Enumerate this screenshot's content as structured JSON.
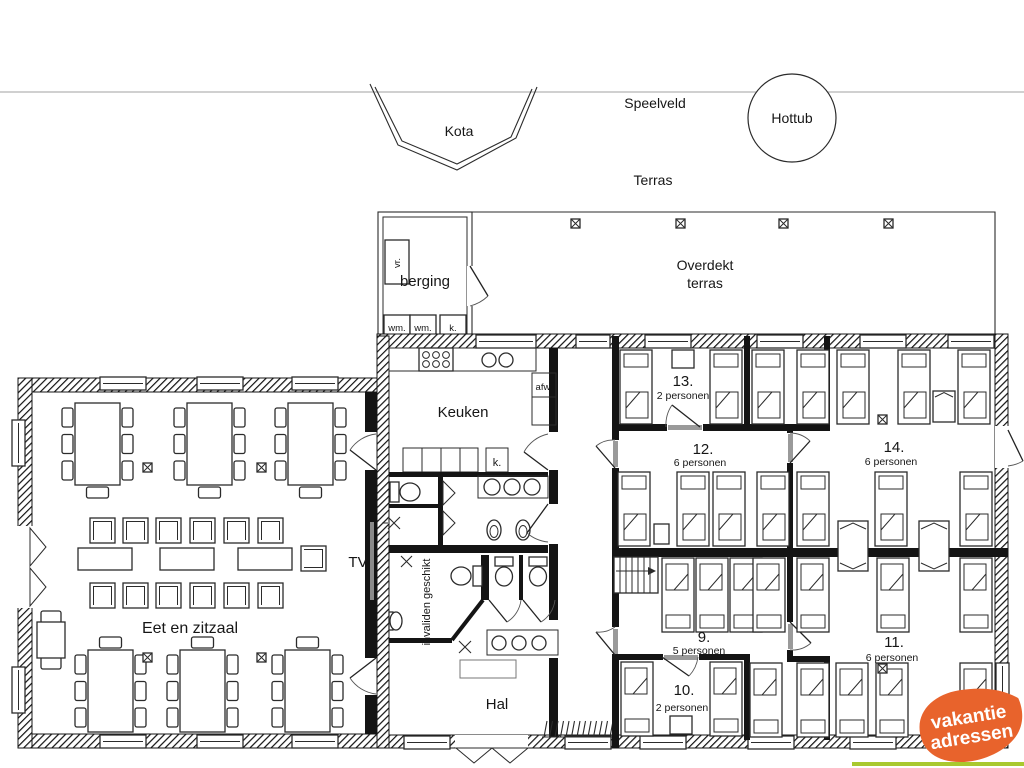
{
  "outdoor": {
    "kota": "Kota",
    "speelveld": "Speelveld",
    "hottub": "Hottub",
    "terras": "Terras",
    "overdekt1": "Overdekt",
    "overdekt2": "terras"
  },
  "berging": {
    "label": "berging",
    "vr": "vr.",
    "wm1": "wm.",
    "wm2": "wm.",
    "k": "k."
  },
  "kitchen": {
    "label": "Keuken",
    "afw": "afw.",
    "k": "k."
  },
  "dining": {
    "label": "Eet  en zitzaal",
    "tv": "TV"
  },
  "hal": {
    "label": "Hal",
    "invaliden": "invaliden geschikt"
  },
  "rooms": {
    "r13": {
      "number": "13.",
      "capacity": "2 personen"
    },
    "r12": {
      "number": "12.",
      "capacity": "6 personen"
    },
    "r14": {
      "number": "14.",
      "capacity": "6 personen"
    },
    "r9": {
      "number": "9.",
      "capacity": "5 personen"
    },
    "r10": {
      "number": "10.",
      "capacity": "2 personen"
    },
    "r11": {
      "number": "11.",
      "capacity": "6 personen"
    }
  },
  "logo": {
    "line1": "vakantie",
    "line2": "adressen",
    "orange": "#e8632c",
    "green": "#a9c92f"
  }
}
